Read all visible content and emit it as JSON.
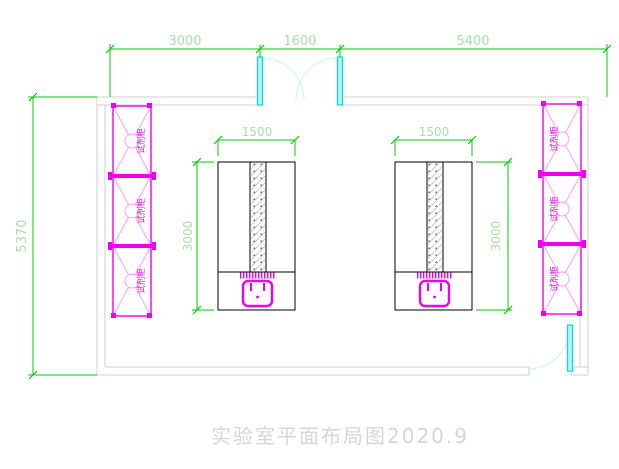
{
  "drawing": {
    "title": "实验室平面布局图2020.9",
    "dims": {
      "top_left": "3000",
      "top_mid": "1600",
      "top_right": "5400",
      "left": "5370",
      "bench_width": "1500",
      "bench_depth": "3000"
    },
    "cabinet_label": "试剂柜",
    "colors": {
      "dim_line": "#00cc00",
      "dim_text": "#a8e0a8",
      "wall": "#cfcfcf",
      "magenta": "#ee00ee",
      "magenta_light": "#ff9bff",
      "cyan": "#00dede",
      "cyan_light": "#c6f2f2",
      "bench": "#000000",
      "title": "#d6d6d6"
    }
  }
}
